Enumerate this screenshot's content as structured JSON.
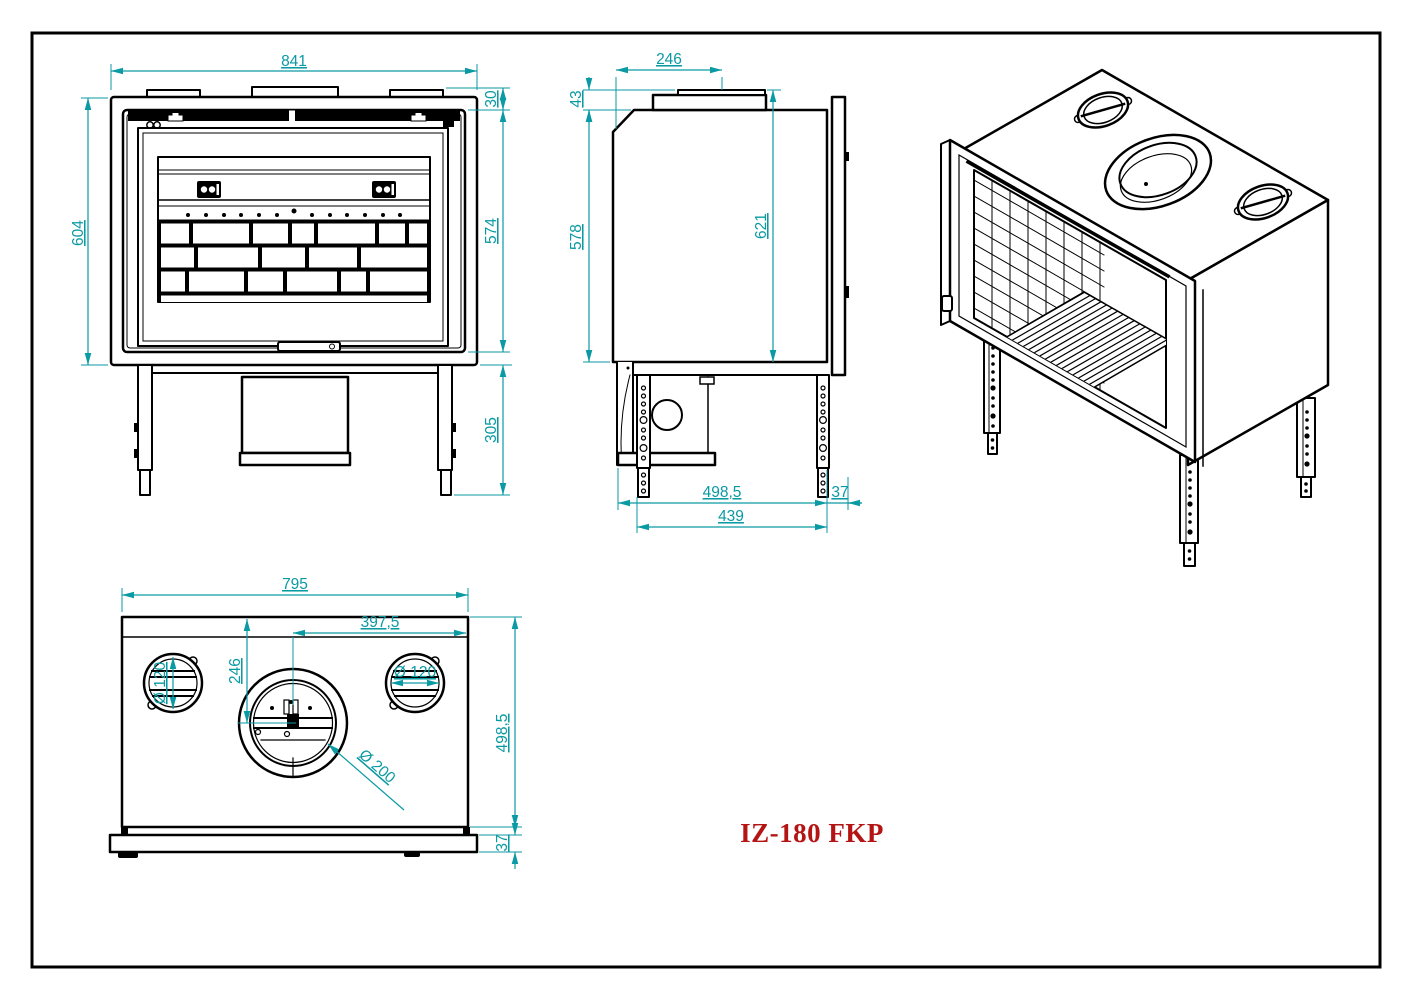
{
  "title": "IZ-180 FKP",
  "colors": {
    "dimension_teal": "#0a9aa3",
    "drawing_line": "#000000",
    "title_red": "#b51414",
    "background": "#ffffff"
  },
  "front_view": {
    "width": "841",
    "top_offset": "30",
    "door_height": "574",
    "body_height": "604",
    "leg_height": "305"
  },
  "side_view": {
    "collar_width": "246",
    "collar_height": "43",
    "body_height": "578",
    "total_height": "621",
    "depth": "498,5",
    "leg_span": "439",
    "frame_depth": "37"
  },
  "bottom_view": {
    "width": "795",
    "half_width": "397,5",
    "flue_offset": "246",
    "left_vent_diameter": "Ø 120",
    "right_vent_diameter": "Ø 120",
    "flue_diameter": "Ø 200",
    "depth": "498,5",
    "base_height": "37"
  }
}
